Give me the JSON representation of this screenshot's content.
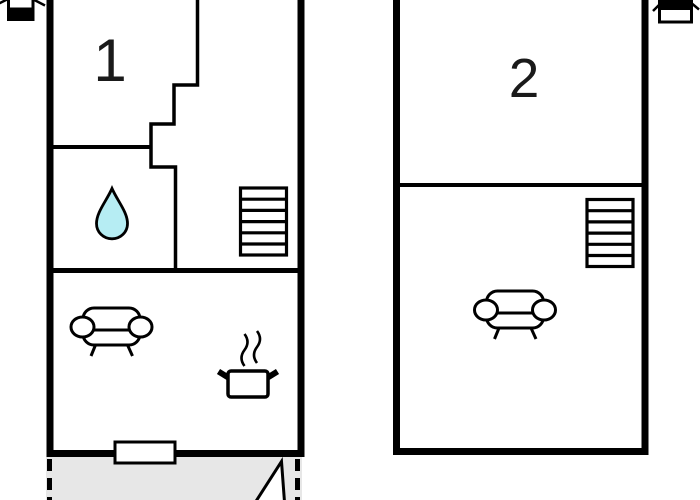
{
  "title": "Two-unit floor plan",
  "colors": {
    "wall": "#000000",
    "background": "#ffffff",
    "terrace": "#e7e7e7",
    "water": "#b6edf3",
    "white": "#ffffff"
  },
  "units": [
    {
      "label": "1",
      "icons": [
        "water-drop",
        "stairs",
        "sofa",
        "cooking-pot",
        "door-opening",
        "terrace"
      ]
    },
    {
      "label": "2",
      "icons": [
        "stairs",
        "sofa"
      ]
    }
  ],
  "corner_icons": {
    "top_left": "ceiling-lamp",
    "top_right": "ceiling-lamp"
  },
  "terrace_icons": [
    "sail"
  ]
}
